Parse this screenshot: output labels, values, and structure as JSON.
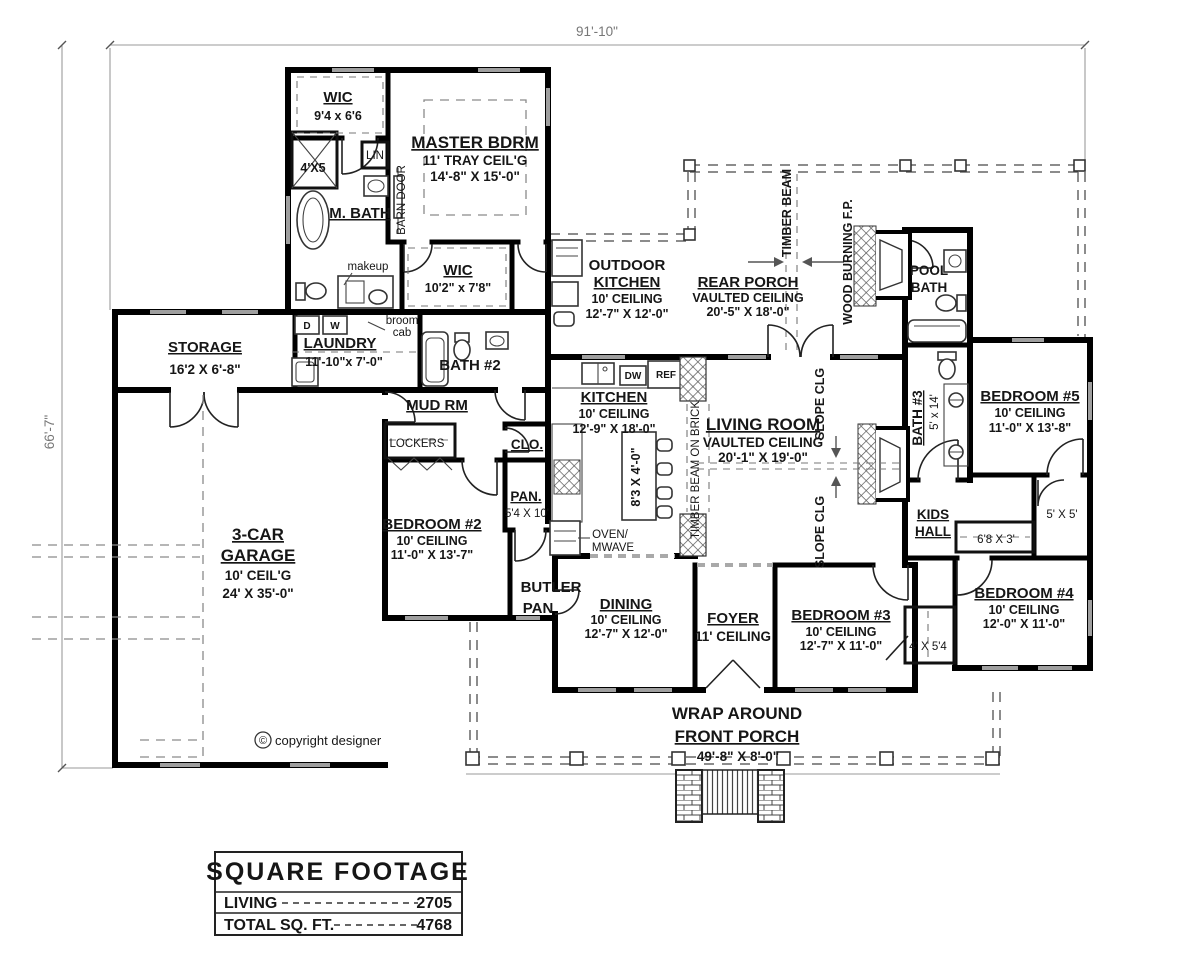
{
  "sheet": {
    "dim_top": "91'-10\"",
    "dim_left": "66'-7\"",
    "copyright_symbol": "©",
    "copyright": "copyright designer"
  },
  "rooms": {
    "wic1": {
      "name": "WIC",
      "size": "9'4 x 6'6"
    },
    "shower": {
      "size": "4'X5"
    },
    "lin": {
      "name": "LIN"
    },
    "mbath": {
      "name": "M. BATH"
    },
    "barn_door": {
      "name": "BARN DOOR"
    },
    "master": {
      "name": "MASTER BDRM",
      "ceiling": "11' TRAY CEIL'G",
      "size": "14'-8\" X 15'-0\""
    },
    "makeup": {
      "name": "makeup"
    },
    "wic2": {
      "name": "WIC",
      "size": "10'2\" x 7'8\""
    },
    "broom": {
      "line1": "broom",
      "line2": "cab"
    },
    "dryer": "D",
    "washer": "W",
    "storage": {
      "name": "STORAGE",
      "size": "16'2 X 6'-8\""
    },
    "laundry": {
      "name": "LAUNDRY",
      "size": "11'-10\"x 7'-0\""
    },
    "bath2": {
      "name": "BATH #2"
    },
    "mud": {
      "name": "MUD RM"
    },
    "lockers": {
      "name": "LOCKERS"
    },
    "clo": {
      "name": "CLO."
    },
    "pan": {
      "name": "PAN.",
      "size": "5'4 X 10'"
    },
    "outdoor_kitchen": {
      "line1": "OUTDOOR",
      "line2": "KITCHEN",
      "ceiling": "10' CEILING",
      "size": "12'-7\" X 12'-0\""
    },
    "rear_porch": {
      "name": "REAR PORCH",
      "ceiling": "VAULTED CEILING",
      "size": "20'-5\" X 18'-0\""
    },
    "timber_beam": "TIMBER BEAM",
    "wood_fp": "WOOD BURNING F.P.",
    "pool_bath": {
      "line1": "POOL",
      "line2": "BATH"
    },
    "kitchen": {
      "name": "KITCHEN",
      "ceiling": "10' CEILING",
      "size": "12'-9\" X 18'-0\""
    },
    "island_size": "8'3 X 4'-0\"",
    "timber_brick": "TIMBER BEAM ON BRICK",
    "living": {
      "name": "LIVING ROOM",
      "ceiling": "VAULTED CEILING",
      "size": "20'-1\" X 19'-0\""
    },
    "slope_clg": "SLOPE CLG",
    "bath3": {
      "name": "BATH #3",
      "size": "5' x 14'"
    },
    "bedroom5": {
      "name": "BEDROOM #5",
      "ceiling": "10' CEILING",
      "size": "11'-0\" X 13'-8\""
    },
    "garage": {
      "line1": "3-CAR",
      "line2": "GARAGE",
      "ceiling": "10' CEIL'G",
      "size": "24' X 35'-0\""
    },
    "bedroom2": {
      "name": "BEDROOM #2",
      "ceiling": "10' CEILING",
      "size": "11'-0\" X 13'-7\""
    },
    "oven": {
      "line1": "OVEN/",
      "line2": "MWAVE"
    },
    "butler": {
      "line1": "BUTLER",
      "line2": "PAN"
    },
    "dining": {
      "name": "DINING",
      "ceiling": "10' CEILING",
      "size": "12'-7\" X 12'-0\""
    },
    "foyer": {
      "name": "FOYER",
      "ceiling": "11' CEILING"
    },
    "bedroom3": {
      "name": "BEDROOM #3",
      "ceiling": "10' CEILING",
      "size": "12'-7\" X 11'-0\""
    },
    "closet_b3": "4' X 5'4",
    "kids_hall": {
      "line1": "KIDS",
      "line2": "HALL"
    },
    "closet_68": "6'8 X 3'",
    "closet_55": "5' X 5'",
    "bedroom4": {
      "name": "BEDROOM #4",
      "ceiling": "10' CEILING",
      "size": "12'-0\" X 11'-0\""
    },
    "front_porch": {
      "line1": "WRAP AROUND",
      "line2": "FRONT PORCH",
      "size": "49'-8\" X 8'-0\""
    },
    "ref": "REF",
    "dw": "DW"
  },
  "table": {
    "title": "SQUARE FOOTAGE",
    "rows": [
      {
        "label": "LIVING",
        "value": "2705"
      },
      {
        "label": "TOTAL SQ. FT.",
        "value": "4768"
      }
    ]
  }
}
